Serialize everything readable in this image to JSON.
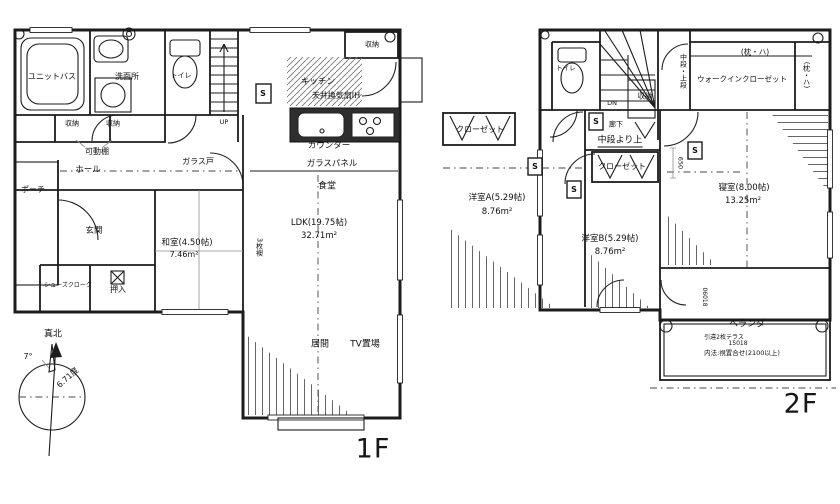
{
  "floor1": {
    "label": "1F",
    "rooms": {
      "unit_bath": "ユニットバス",
      "washroom": "洗面所",
      "toilet": "トイレ",
      "storage": "収納",
      "movable_shelf": "可動棚",
      "hall": "ホール",
      "glass_door": "ガラス戸",
      "porch": "ポーチ",
      "entrance": "玄関",
      "shoes_closet": "シューズクローク",
      "oshiire": "押入",
      "japanese_room": "和室(4.50帖)",
      "japanese_room_area": "7.46m²",
      "fusuma": "3枚襖",
      "kitchen": "キッチン",
      "kitchen_note": "天井換気扇IH",
      "counter": "カウンター",
      "glass_panel": "ガラスパネル",
      "dining": "食堂",
      "ldk": "LDK(19.75帖)",
      "ldk_area": "32.71m²",
      "living": "居間",
      "tv_space": "TV置場",
      "stairs_up": "UP",
      "shutter": "S"
    }
  },
  "floor2": {
    "label": "2F",
    "rooms": {
      "toilet": "トイレ",
      "stairs_dn": "DN",
      "corridor": "廊下",
      "storage": "収納",
      "shelf_levels": "中段・上段",
      "walk_in_closet": "ウォークインクローゼット",
      "pillow_shelf": "(枕・ハ)",
      "mid_landing_note": "中段より上",
      "closet": "クローゼット",
      "western_a": "洋室A(5.29帖)",
      "western_a_area": "8.76m²",
      "western_b": "洋室B(5.29帖)",
      "western_b_area": "8.76m²",
      "bedroom": "寝室(8.00帖)",
      "bedroom_area": "13.25m²",
      "dim_650": "650",
      "veranda": "ベランダ",
      "terrace_door": "引違2枚テラス",
      "terrace_code": "15018",
      "inner_note": "内法:視置合せ(2100以上)",
      "window_code": "06018",
      "shutter": "S"
    }
  },
  "compass": {
    "true_north": "真北",
    "declination_small": "7°",
    "declination": "6.71度"
  },
  "colors": {
    "line": "#1c1c1c",
    "counter_fill": "#2e2e2e",
    "bay_fill": "#c9c9c9",
    "hatch": "#666666",
    "background": "#ffffff"
  }
}
